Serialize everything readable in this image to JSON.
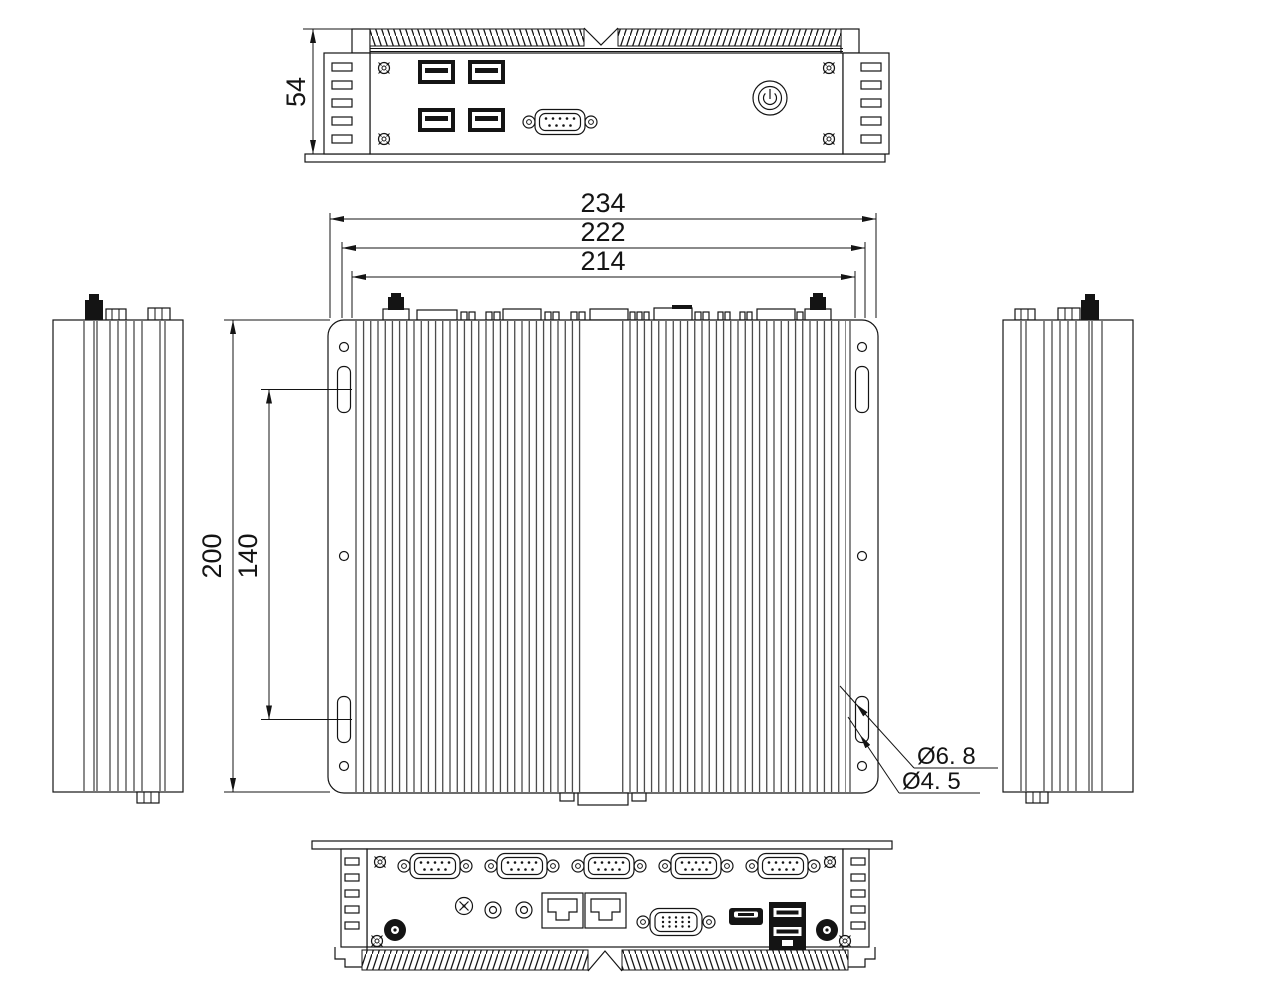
{
  "dims": {
    "front_height": "54",
    "overall_width": "234",
    "mid_width": "222",
    "inner_width": "214",
    "overall_depth": "200",
    "slot_spacing": "140",
    "slot_dia": "Ø6. 8",
    "hole_dia": "Ø4. 5"
  },
  "views": {
    "front": {
      "ports": [
        "usb-port",
        "usb-port",
        "usb-port",
        "usb-port",
        "db9-serial-port",
        "power-button"
      ]
    },
    "top_plan": {
      "features": [
        "cooling-fins",
        "mounting-keyhole-slot x4",
        "screw-hole x6",
        "antenna-connector x2"
      ]
    },
    "left_side": {
      "features": [
        "cooling-fins",
        "antenna-connector"
      ]
    },
    "right_side": {
      "features": [
        "cooling-fins",
        "antenna-connector"
      ]
    },
    "rear": {
      "ports": [
        "db9-serial-port",
        "db9-serial-port",
        "db9-serial-port",
        "db9-serial-port",
        "db9-serial-port",
        "dc-power-jack",
        "audio-jack",
        "audio-jack",
        "rj45-lan",
        "rj45-lan",
        "vga-port",
        "hdmi-port",
        "usb-stack",
        "antenna-connector",
        "antenna-connector"
      ]
    }
  }
}
